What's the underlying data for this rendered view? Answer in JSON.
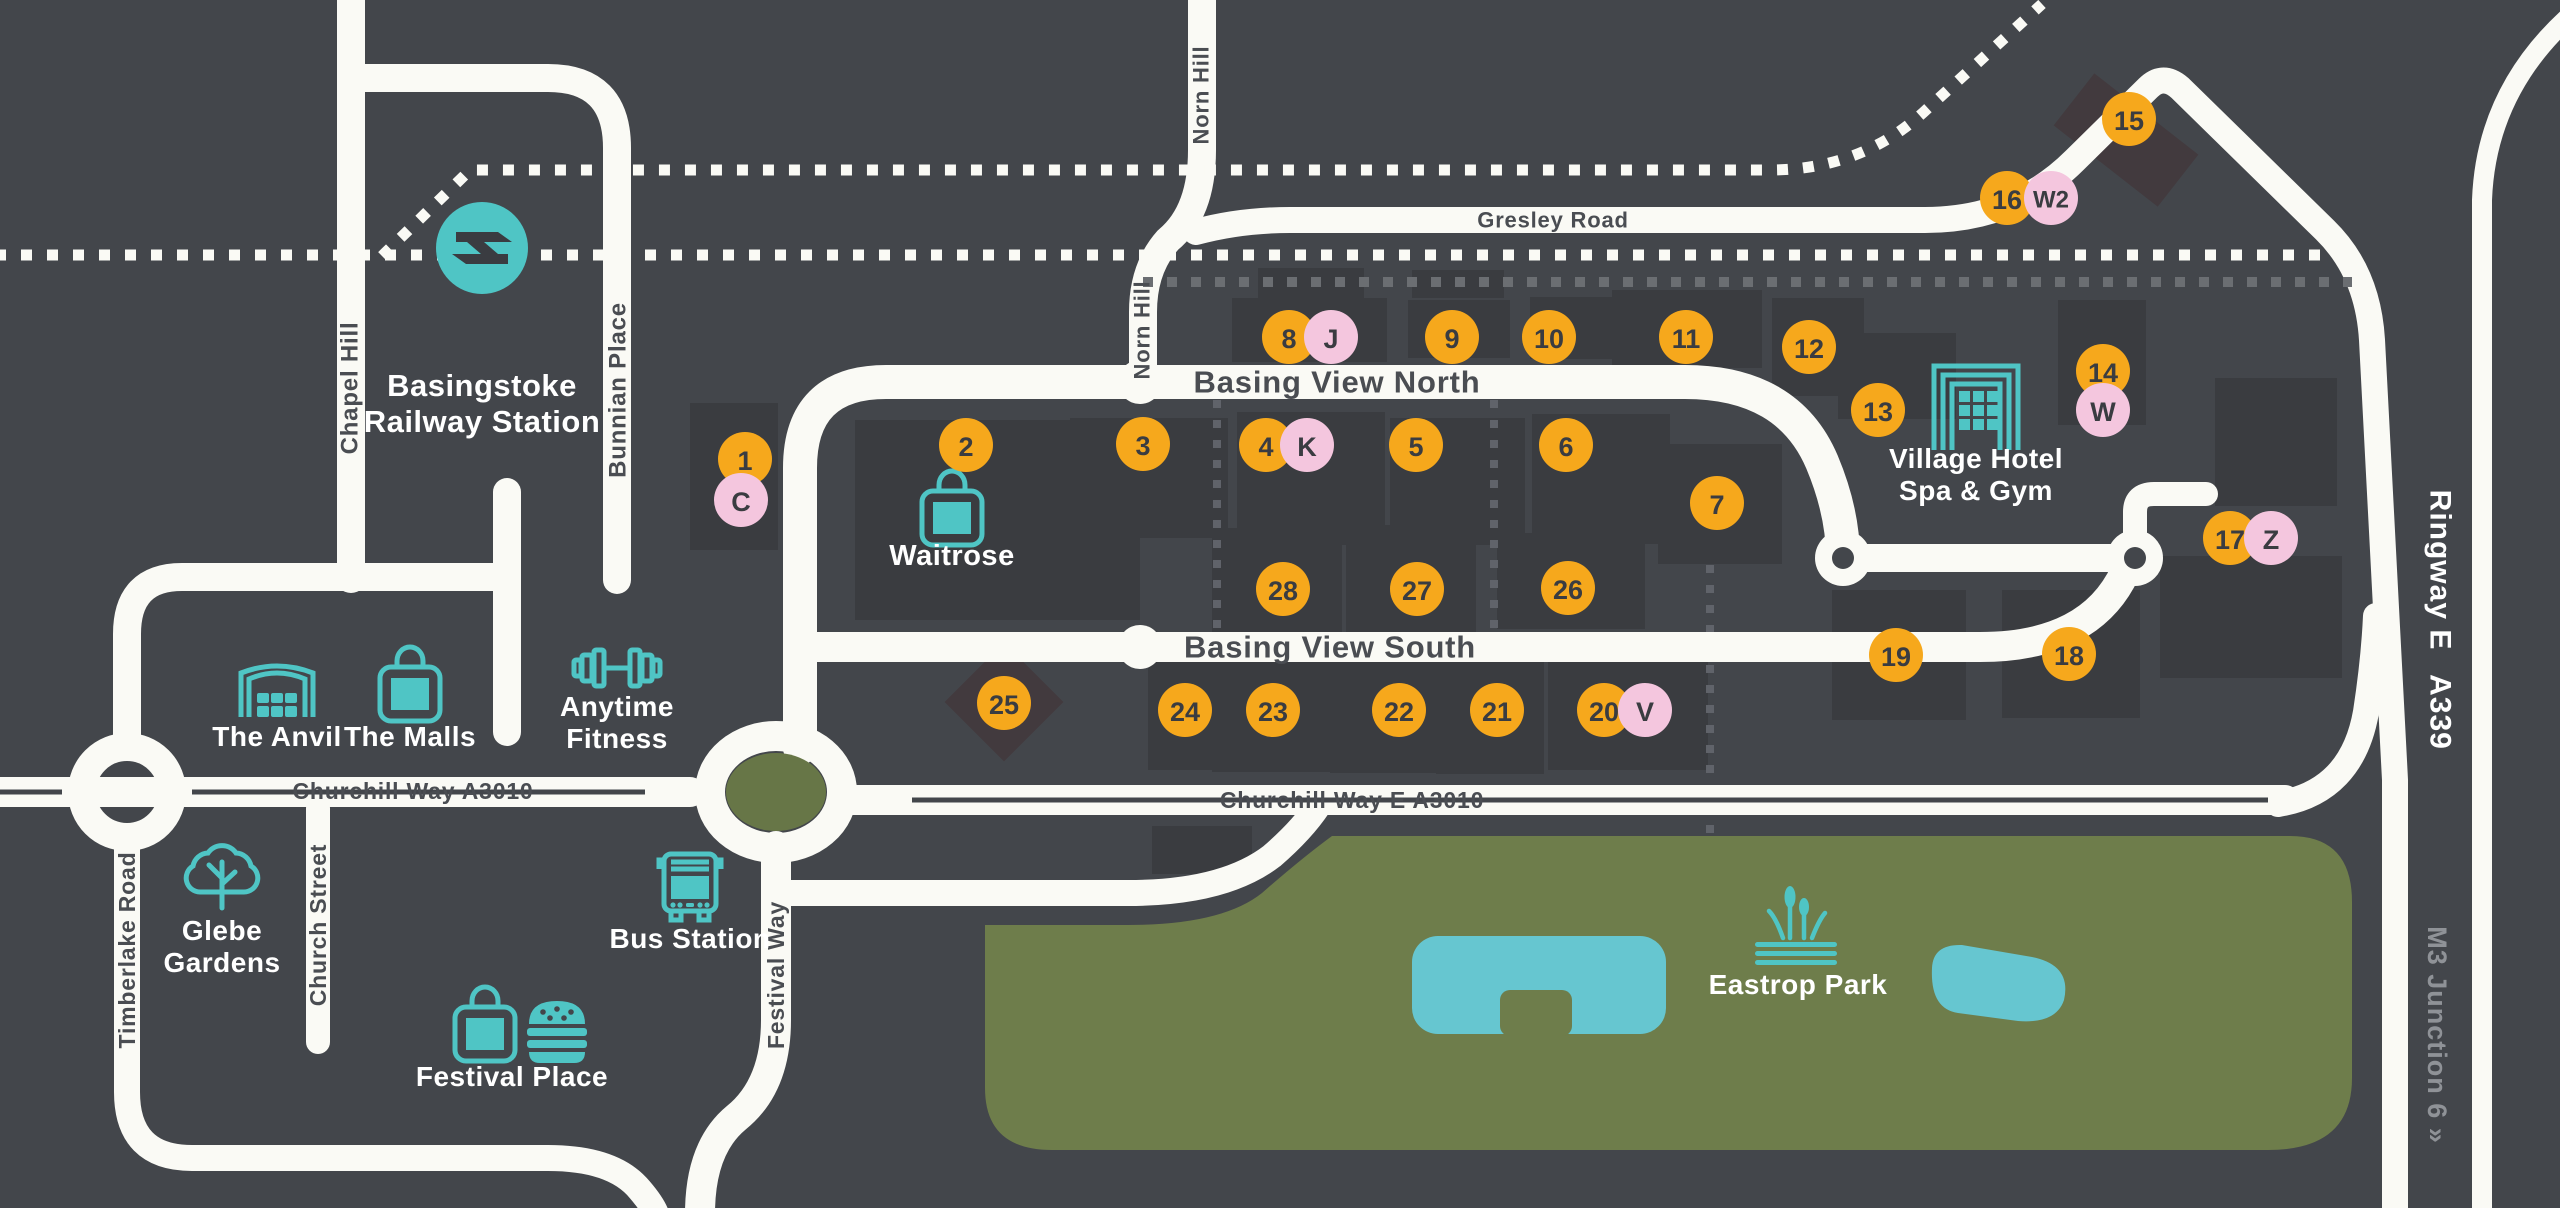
{
  "map": {
    "title": "Basing View area map",
    "colors": {
      "background": "#43464b",
      "building": "#3a3c40",
      "building_alt": "#423a3e",
      "road": "#fafaf5",
      "park_green": "#6e7d4b",
      "roundabout_green": "#677647",
      "lake_teal": "#66c6d0",
      "icon_teal": "#4fc5c5",
      "marker_orange": "#f6a81c",
      "marker_pink": "#f4c6de",
      "road_label_dark": "#4a4d52",
      "label_white": "#ffffff",
      "label_gray": "#8f9297"
    },
    "road_labels": [
      {
        "id": "chapel-hill",
        "text": "Chapel Hill",
        "x": 350,
        "y": 388,
        "rot": -90,
        "cls": "road-label",
        "size": 24
      },
      {
        "id": "bunnian-place",
        "text": "Bunnian Place",
        "x": 618,
        "y": 390,
        "rot": -90,
        "cls": "road-label",
        "size": 24
      },
      {
        "id": "norn-hill-upper",
        "text": "Norn Hill",
        "x": 1201,
        "y": 95,
        "rot": -90,
        "cls": "road-label",
        "size": 22
      },
      {
        "id": "norn-hill-lower",
        "text": "Norn Hill",
        "x": 1142,
        "y": 330,
        "rot": -90,
        "cls": "road-label",
        "size": 22
      },
      {
        "id": "gresley-road",
        "text": "Gresley Road",
        "x": 1553,
        "y": 220,
        "rot": 0,
        "cls": "road-label",
        "size": 22
      },
      {
        "id": "basing-view-north",
        "text": "Basing View North",
        "x": 1337,
        "y": 382,
        "rot": 0,
        "cls": "road-label",
        "size": 31
      },
      {
        "id": "basing-view-south",
        "text": "Basing View South",
        "x": 1330,
        "y": 647,
        "rot": 0,
        "cls": "road-label",
        "size": 31
      },
      {
        "id": "churchill-way-a3010",
        "text": "Churchill Way A3010",
        "x": 413,
        "y": 791,
        "rot": 0,
        "cls": "road-label",
        "size": 23
      },
      {
        "id": "churchill-way-e-a3010",
        "text": "Churchill Way E A3010",
        "x": 1352,
        "y": 800,
        "rot": 0,
        "cls": "road-label",
        "size": 23
      },
      {
        "id": "timberlake-road",
        "text": "Timberlake Road",
        "x": 127,
        "y": 950,
        "rot": -90,
        "cls": "road-label",
        "size": 23
      },
      {
        "id": "church-street",
        "text": "Church Street",
        "x": 318,
        "y": 925,
        "rot": -90,
        "cls": "road-label",
        "size": 23
      },
      {
        "id": "festival-way",
        "text": "Festival Way",
        "x": 776,
        "y": 975,
        "rot": -90,
        "cls": "road-label",
        "size": 23
      },
      {
        "id": "ringway-e",
        "text": "Ringway E",
        "x": 2440,
        "y": 570,
        "rot": 90,
        "cls": "white-label",
        "size": 30
      },
      {
        "id": "a339",
        "text": "A339",
        "x": 2440,
        "y": 712,
        "rot": 90,
        "cls": "white-label",
        "size": 30
      },
      {
        "id": "m3-junction-6",
        "text": "M3 Junction 6 »",
        "x": 2437,
        "y": 1035,
        "rot": 90,
        "cls": "gray-label",
        "size": 27
      }
    ],
    "landmarks": [
      {
        "id": "basingstoke-railway-station",
        "icons": [
          {
            "name": "rail",
            "x": 482,
            "y": 248
          }
        ],
        "lines": [
          {
            "t": "Basingstoke",
            "y": 396
          },
          {
            "t": "Railway Station",
            "y": 432
          }
        ],
        "x": 482,
        "size": 31
      },
      {
        "id": "waitrose",
        "icons": [
          {
            "name": "bag",
            "x": 952,
            "y": 512
          }
        ],
        "lines": [
          {
            "t": "Waitrose",
            "y": 565
          }
        ],
        "x": 952,
        "size": 29
      },
      {
        "id": "the-anvil",
        "icons": [
          {
            "name": "theater",
            "x": 277,
            "y": 690
          }
        ],
        "lines": [
          {
            "t": "The Anvil",
            "y": 746
          }
        ],
        "x": 277,
        "size": 28
      },
      {
        "id": "the-malls",
        "icons": [
          {
            "name": "bag",
            "x": 410,
            "y": 688
          }
        ],
        "lines": [
          {
            "t": "The Malls",
            "y": 746
          }
        ],
        "x": 410,
        "size": 28
      },
      {
        "id": "anytime-fitness",
        "icons": [
          {
            "name": "dumbbell",
            "x": 617,
            "y": 668
          }
        ],
        "lines": [
          {
            "t": "Anytime",
            "y": 716
          },
          {
            "t": "Fitness",
            "y": 748
          }
        ],
        "x": 617,
        "size": 28
      },
      {
        "id": "glebe-gardens",
        "icons": [
          {
            "name": "tree",
            "x": 222,
            "y": 872
          }
        ],
        "lines": [
          {
            "t": "Glebe",
            "y": 940
          },
          {
            "t": "Gardens",
            "y": 972
          }
        ],
        "x": 222,
        "size": 28
      },
      {
        "id": "bus-station",
        "icons": [
          {
            "name": "bus",
            "x": 690,
            "y": 885
          }
        ],
        "lines": [
          {
            "t": "Bus Station",
            "y": 948
          }
        ],
        "x": 690,
        "size": 28
      },
      {
        "id": "festival-place",
        "icons": [
          {
            "name": "bag",
            "x": 485,
            "y": 1028
          },
          {
            "name": "burger",
            "x": 557,
            "y": 1026
          }
        ],
        "lines": [
          {
            "t": "Festival Place",
            "y": 1086
          }
        ],
        "x": 512,
        "size": 28
      },
      {
        "id": "village-hotel-spa-gym",
        "icons": [
          {
            "name": "hotel",
            "x": 1976,
            "y": 408
          }
        ],
        "lines": [
          {
            "t": "Village Hotel",
            "y": 468
          },
          {
            "t": "Spa & Gym",
            "y": 500
          }
        ],
        "x": 1976,
        "size": 28
      },
      {
        "id": "eastrop-park",
        "icons": [
          {
            "name": "reeds",
            "x": 1796,
            "y": 928
          }
        ],
        "lines": [
          {
            "t": "Eastrop Park",
            "y": 994
          }
        ],
        "x": 1798,
        "size": 28
      }
    ],
    "markers": [
      {
        "id": "1",
        "type": "number",
        "x": 745,
        "y": 459
      },
      {
        "id": "C",
        "type": "letter",
        "x": 741,
        "y": 500
      },
      {
        "id": "2",
        "type": "number",
        "x": 966,
        "y": 445
      },
      {
        "id": "3",
        "type": "number",
        "x": 1143,
        "y": 444
      },
      {
        "id": "4",
        "type": "number",
        "x": 1266,
        "y": 445
      },
      {
        "id": "K",
        "type": "letter",
        "x": 1307,
        "y": 445
      },
      {
        "id": "5",
        "type": "number",
        "x": 1416,
        "y": 445
      },
      {
        "id": "6",
        "type": "number",
        "x": 1566,
        "y": 445
      },
      {
        "id": "7",
        "type": "number",
        "x": 1717,
        "y": 503
      },
      {
        "id": "8",
        "type": "number",
        "x": 1289,
        "y": 337
      },
      {
        "id": "J",
        "type": "letter",
        "x": 1331,
        "y": 337
      },
      {
        "id": "9",
        "type": "number",
        "x": 1452,
        "y": 337
      },
      {
        "id": "10",
        "type": "number",
        "x": 1549,
        "y": 337
      },
      {
        "id": "11",
        "type": "number",
        "x": 1686,
        "y": 337
      },
      {
        "id": "12",
        "type": "number",
        "x": 1809,
        "y": 347
      },
      {
        "id": "13",
        "type": "number",
        "x": 1878,
        "y": 410
      },
      {
        "id": "14",
        "type": "number",
        "x": 2103,
        "y": 371
      },
      {
        "id": "W",
        "type": "letter",
        "x": 2103,
        "y": 410
      },
      {
        "id": "15",
        "type": "number",
        "x": 2129,
        "y": 119
      },
      {
        "id": "16",
        "type": "number",
        "x": 2007,
        "y": 198
      },
      {
        "id": "W2",
        "type": "letter",
        "x": 2051,
        "y": 198
      },
      {
        "id": "17",
        "type": "number",
        "x": 2230,
        "y": 538
      },
      {
        "id": "Z",
        "type": "letter",
        "x": 2271,
        "y": 538
      },
      {
        "id": "18",
        "type": "number",
        "x": 2069,
        "y": 654
      },
      {
        "id": "19",
        "type": "number",
        "x": 1896,
        "y": 655
      },
      {
        "id": "20",
        "type": "number",
        "x": 1604,
        "y": 710
      },
      {
        "id": "V",
        "type": "letter",
        "x": 1645,
        "y": 710
      },
      {
        "id": "21",
        "type": "number",
        "x": 1497,
        "y": 710
      },
      {
        "id": "22",
        "type": "number",
        "x": 1399,
        "y": 710
      },
      {
        "id": "23",
        "type": "number",
        "x": 1273,
        "y": 710
      },
      {
        "id": "24",
        "type": "number",
        "x": 1185,
        "y": 710
      },
      {
        "id": "25",
        "type": "number",
        "x": 1004,
        "y": 703
      },
      {
        "id": "26",
        "type": "number",
        "x": 1568,
        "y": 588
      },
      {
        "id": "27",
        "type": "number",
        "x": 1417,
        "y": 589
      },
      {
        "id": "28",
        "type": "number",
        "x": 1283,
        "y": 589
      }
    ]
  }
}
